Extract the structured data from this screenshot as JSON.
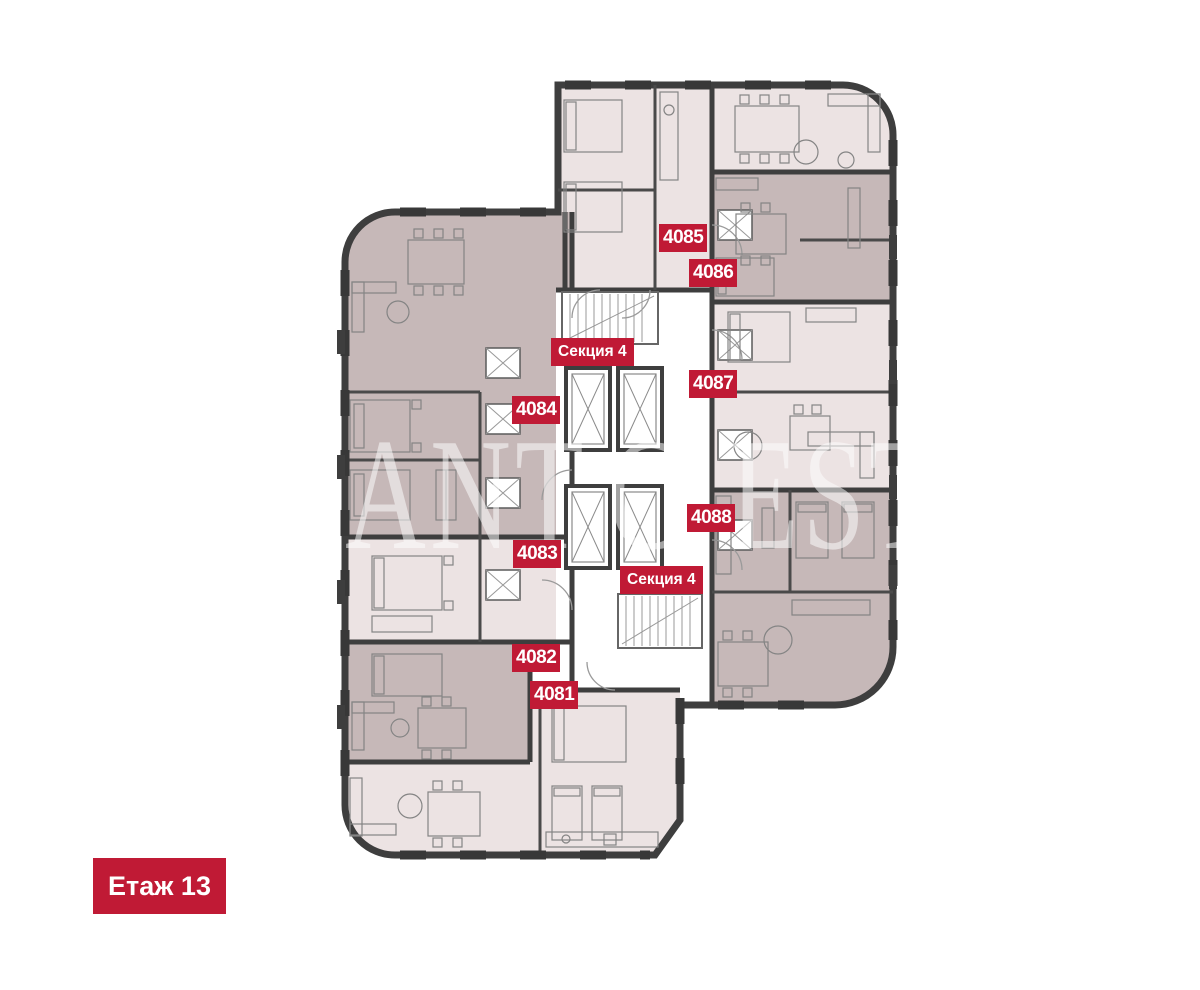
{
  "floor_badge": {
    "label": "Етаж 13"
  },
  "apartment_badges": {
    "b4081": "4081",
    "b4082": "4082",
    "b4083": "4083",
    "b4084": "4084",
    "b4085": "4085",
    "b4086": "4086",
    "b4087": "4087",
    "b4088": "4088"
  },
  "section_badges": {
    "top": "Секция 4",
    "bottom": "Секция 4"
  },
  "watermark": {
    "part1": "ANT",
    "part2": "C",
    "part3": "EST"
  },
  "colors": {
    "badge_red": "#c01a35",
    "apartment_light": "#ece3e3",
    "apartment_dark": "#c6b8b8",
    "wall_dark": "#3e3e3e",
    "background": "#ffffff"
  }
}
